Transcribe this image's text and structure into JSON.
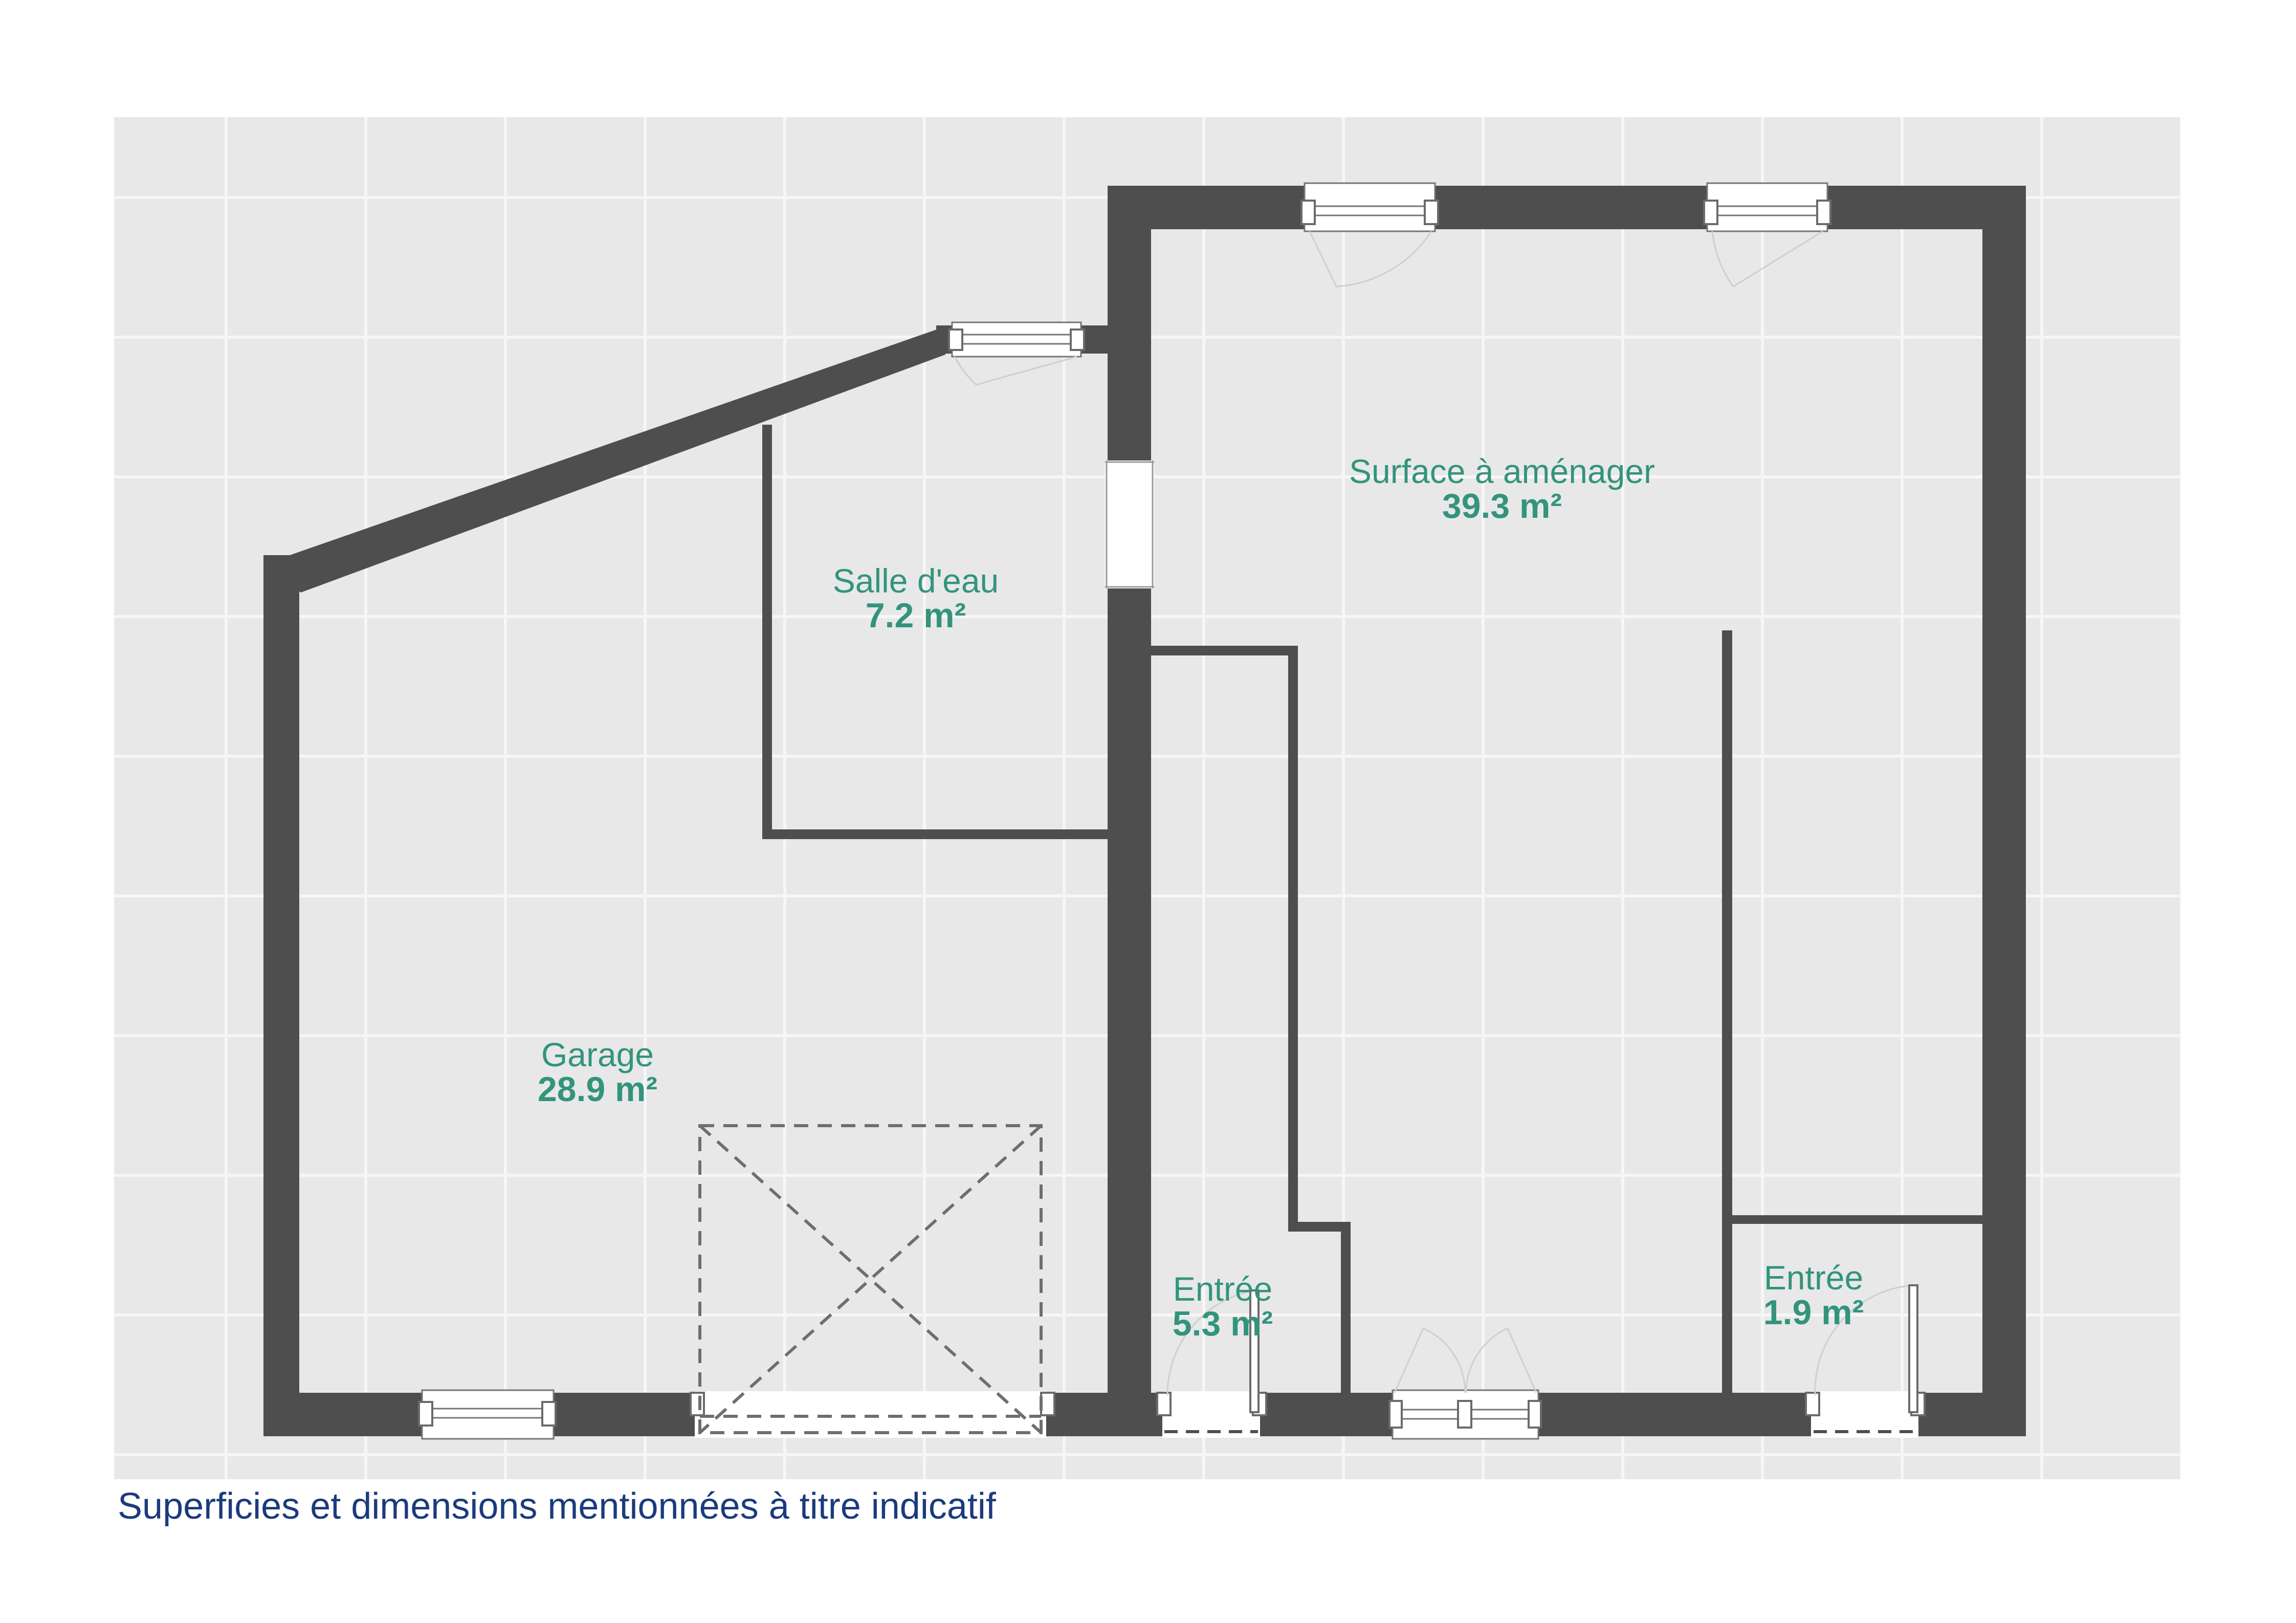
{
  "plan": {
    "type": "floor-plan",
    "caption": "Superficies et dimensions mentionnées à titre indicatif",
    "colors": {
      "wall": "#4E4E4E",
      "background_grid": "#E8E8E8",
      "room_label": "#33947C",
      "caption": "#1B3B7D"
    },
    "rooms": [
      {
        "id": "surface-amenager",
        "name": "Surface à aménager",
        "area": "39.3 m²"
      },
      {
        "id": "salle-eau",
        "name": "Salle d'eau",
        "area": "7.2 m²"
      },
      {
        "id": "garage",
        "name": "Garage",
        "area": "28.9 m²"
      },
      {
        "id": "entree-1",
        "name": "Entrée",
        "area": "5.3 m²"
      },
      {
        "id": "entree-2",
        "name": "Entrée",
        "area": "1.9 m²"
      }
    ]
  }
}
